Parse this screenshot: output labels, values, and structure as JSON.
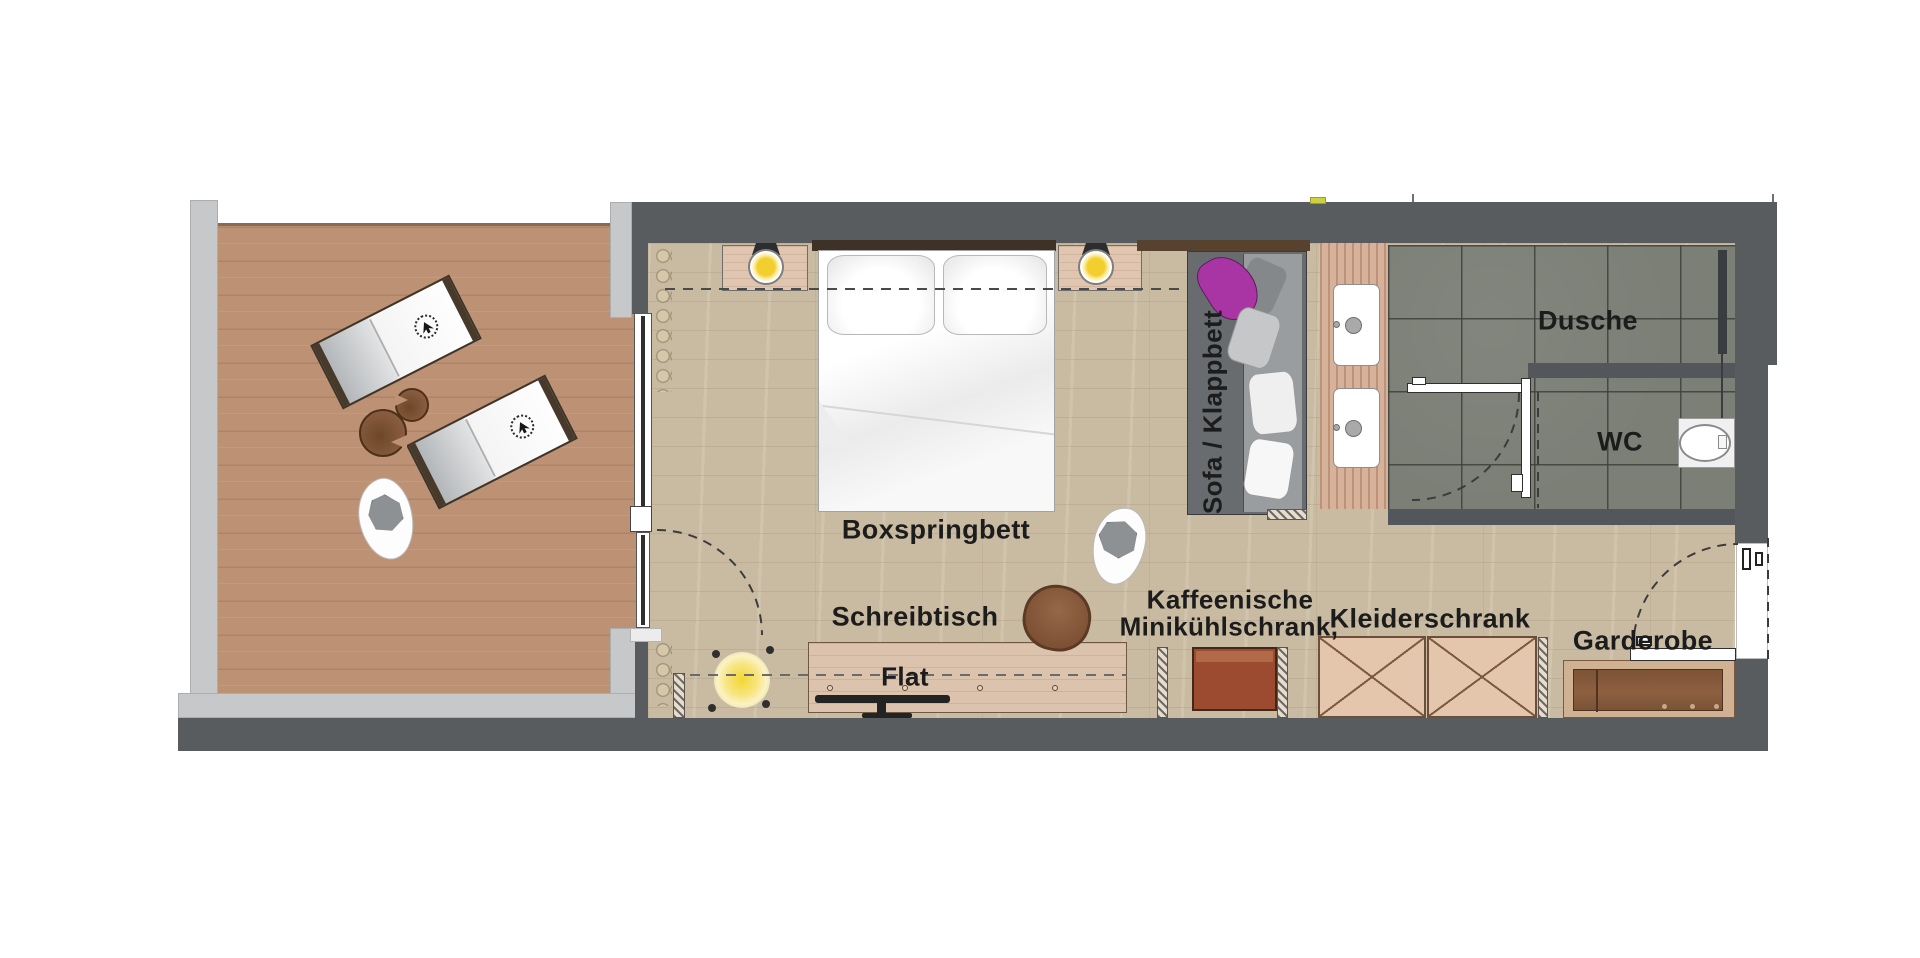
{
  "meta": {
    "title": "Grundriss Hotelzimmer mit Terrasse"
  },
  "labels": {
    "bed": "Boxspringbett",
    "desk": "Schreibtisch",
    "tv": "Flat",
    "coffee": "Kaffeenische",
    "minifridge": "Minikühlschrank,",
    "wardrobe": "Kleiderschrank",
    "coatrack": "Garderobe",
    "shower": "Dusche",
    "toilet": "WC",
    "sofa": "Sofa / Klappbett"
  },
  "colors": {
    "wall_dark": "#585c5f",
    "wall_light": "#c6c8ca",
    "terrace_deck": "#bd9173",
    "room_wood": "#c9bba2",
    "bath_tile": "#7b7f76",
    "accent_purple": "#a835a3",
    "lamp_yellow": "#f3d732",
    "minibar_brown": "#9c4a30",
    "wardrobe_tan": "#e3c6ac",
    "text": "#1c1c1c"
  },
  "icons": {
    "bed_lamps": "bedside-lamp-icon",
    "floor_lamp": "floor-lamp-icon",
    "parasol": "parasol-icon",
    "plants": "plant-icon",
    "tv": "flatscreen-icon",
    "toilet": "toilet-icon",
    "shower_rail": "shower-rail-icon"
  }
}
